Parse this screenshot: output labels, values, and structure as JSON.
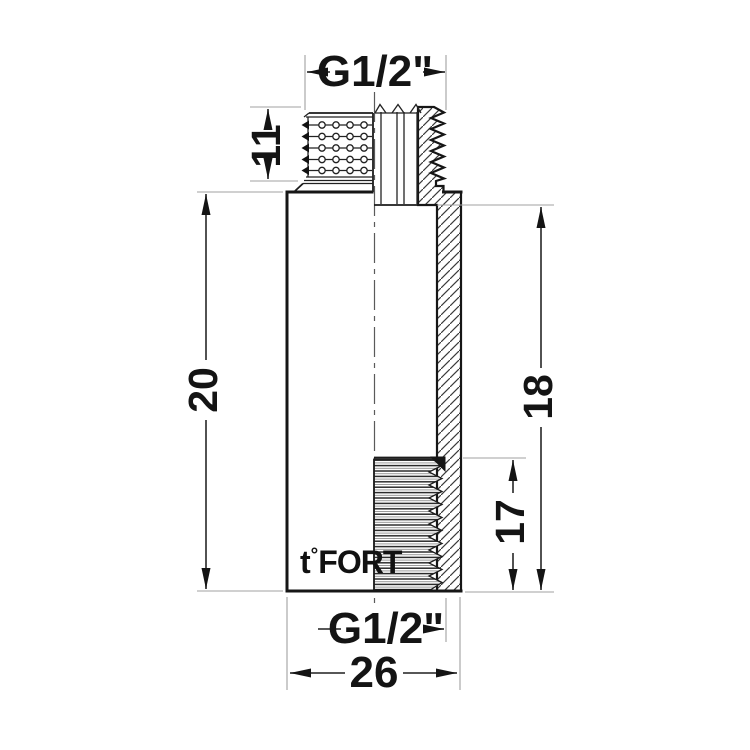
{
  "drawing": {
    "type": "technical-sectional-drawing",
    "subject": "threaded pipe extension fitting, half section view",
    "dimensions": {
      "thread_top": "G1/2\"",
      "male_thread_length": "11",
      "overall_length": "20",
      "socket_depth": "18",
      "female_thread_length": "17",
      "thread_bottom": "G1/2\"",
      "body_width": "26"
    },
    "logo": {
      "t": "t",
      "degree": "°",
      "name": "FORT"
    },
    "colors": {
      "background": "#ffffff",
      "outline": "#161616",
      "dimension_line": "#3f3f3f",
      "extension_line": "#a0a0a0",
      "text": "#141414"
    }
  }
}
